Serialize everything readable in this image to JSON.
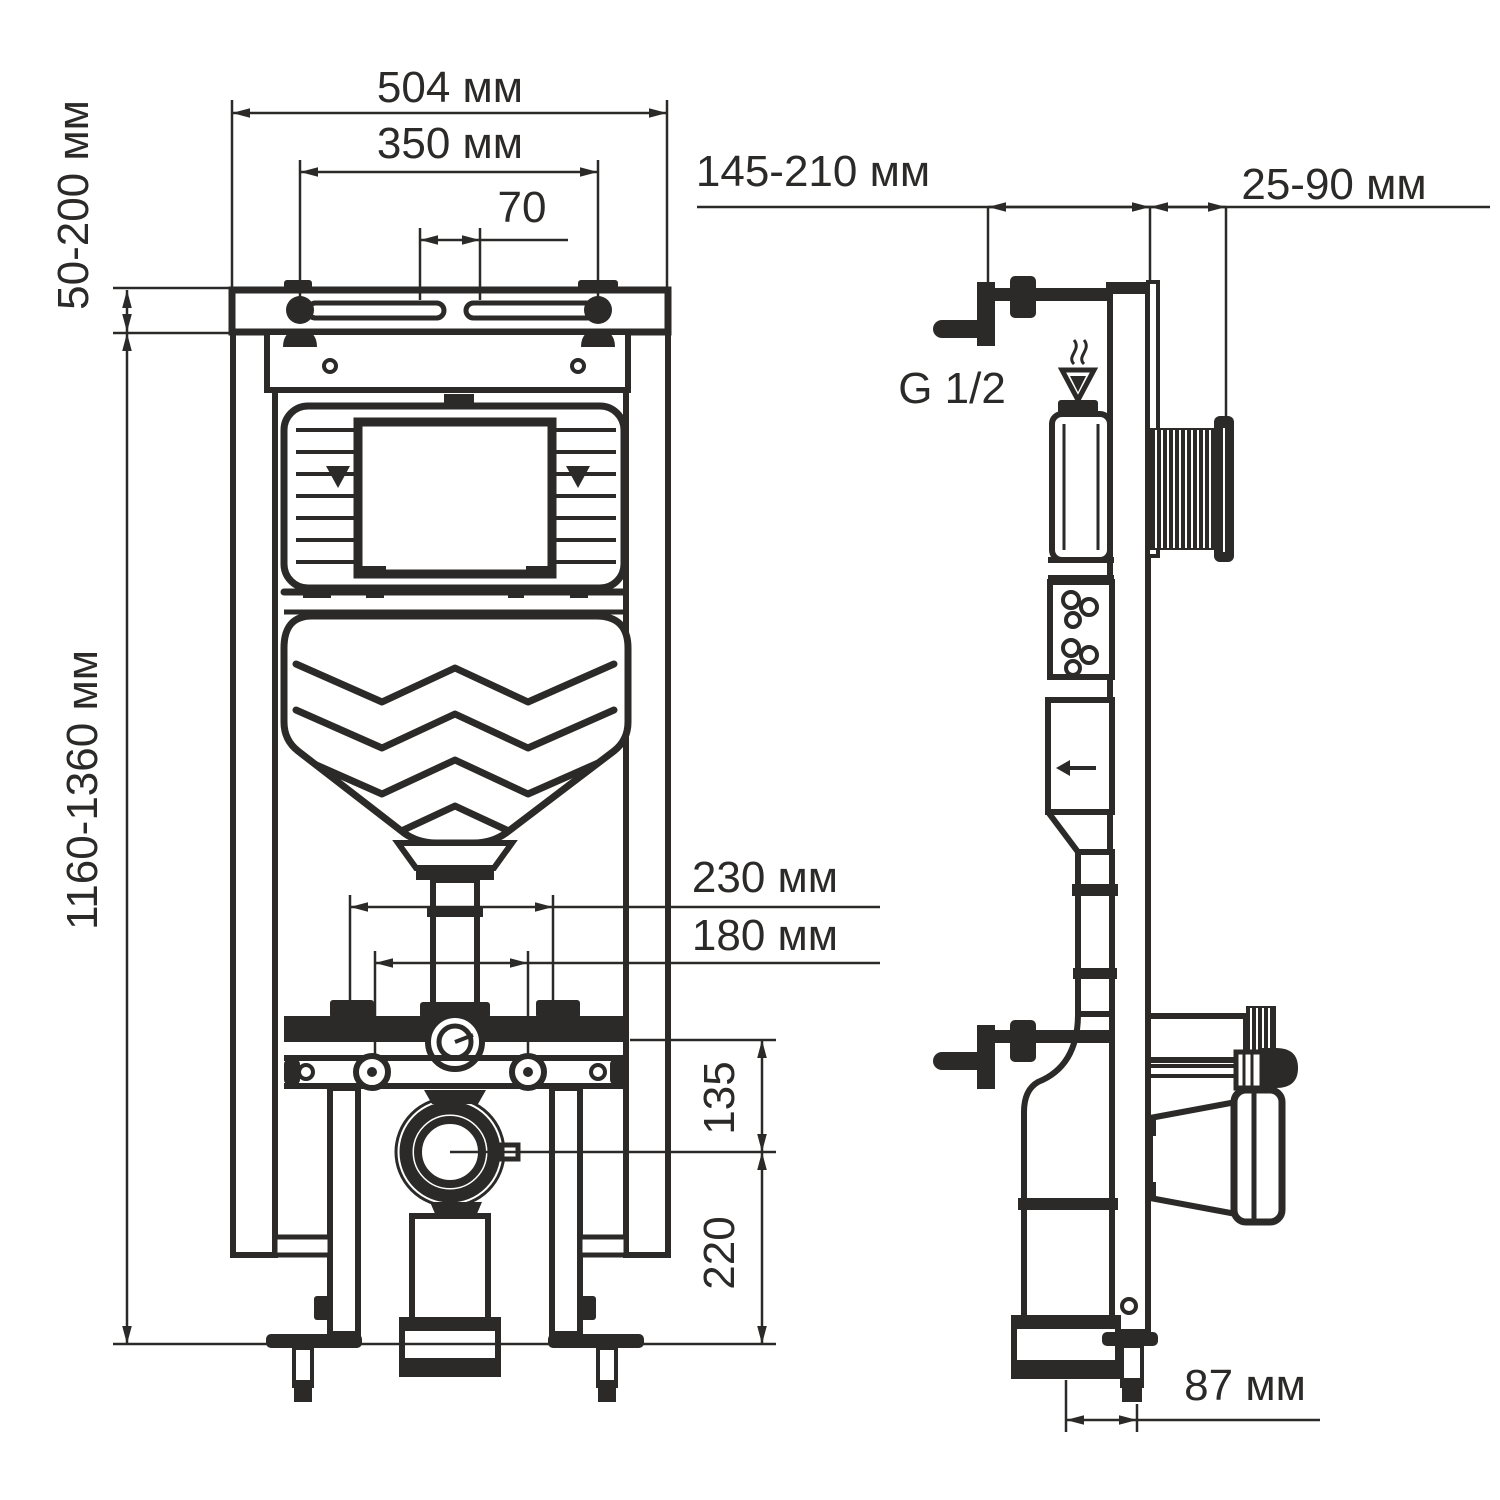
{
  "colors": {
    "ink": "#2b2a29",
    "paper": "#ffffff"
  },
  "front_view": {
    "dim_overall_width": "504 мм",
    "dim_stud_spacing": "350 мм",
    "dim_slot_offset": "70",
    "dim_top_bracket_range": "50-200 мм",
    "dim_frame_height_range": "1160-1360 мм",
    "dim_wc_bolts_wide": "230 мм",
    "dim_wc_bolts_narrow": "180 мм",
    "dim_inlet_to_outlet": "135",
    "dim_outlet_to_floor": "220"
  },
  "side_view": {
    "dim_wall_distance_range": "145-210 мм",
    "dim_button_rod_range": "25-90 мм",
    "label_water_connection": "G 1/2",
    "dim_outlet_wall_offset": "87 мм"
  }
}
